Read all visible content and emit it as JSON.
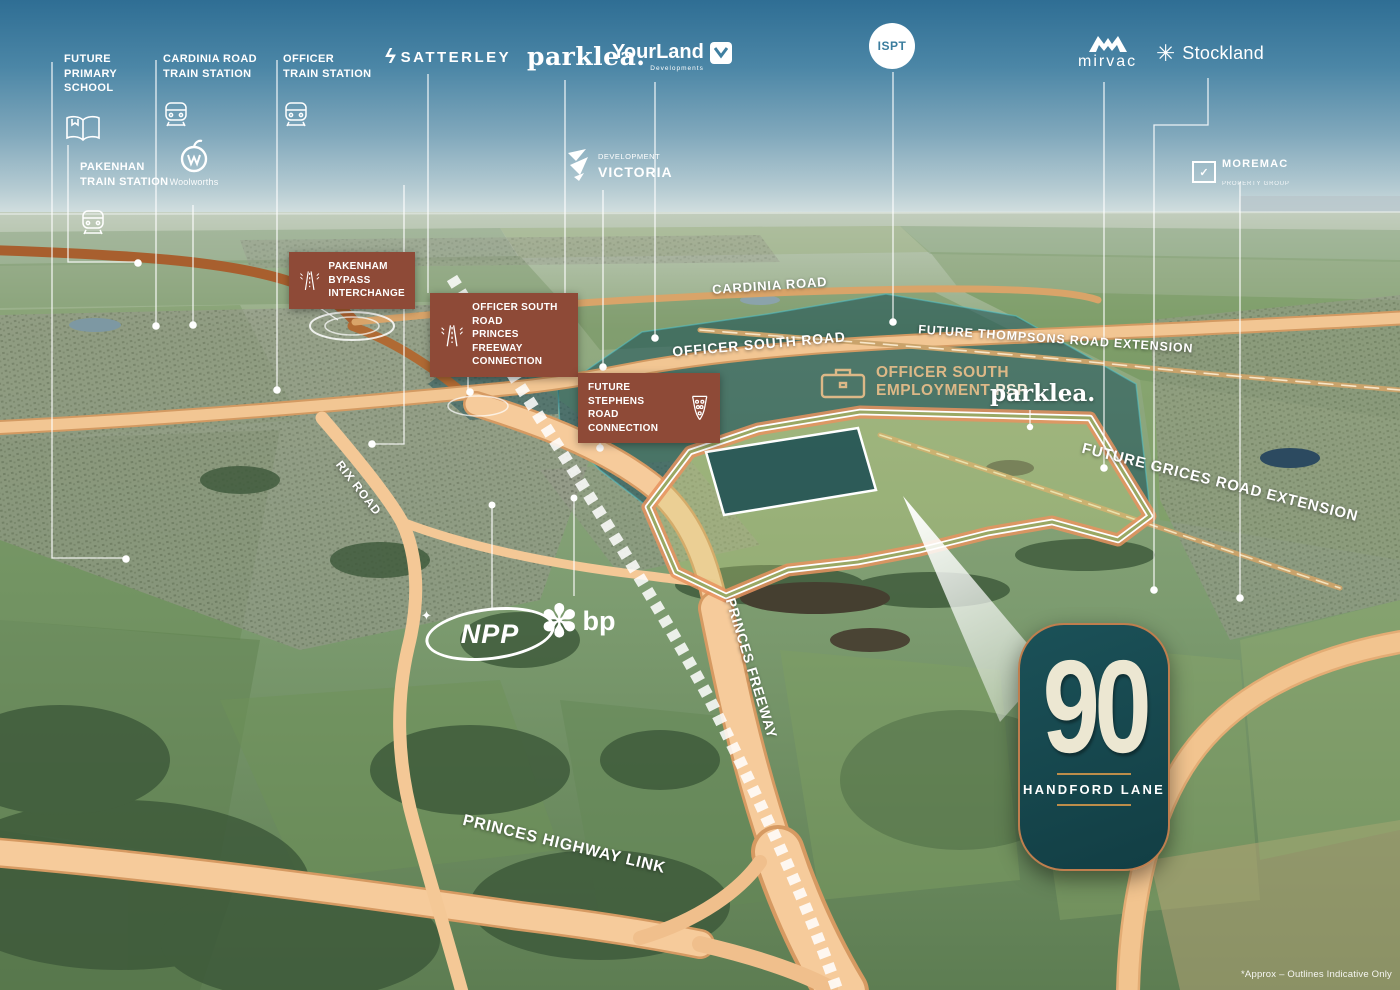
{
  "fine_print": "*Approx – Outlines Indicative Only",
  "badge": {
    "number": "90",
    "name": "HANDFORD LANE"
  },
  "poi": [
    {
      "id": "future-primary-school",
      "text": "FUTURE\nPRIMARY\nSCHOOL",
      "icon": "book-icon"
    },
    {
      "id": "pakenhan-train-station",
      "text": "PAKENHAN\nTRAIN STATION",
      "icon": "train-icon"
    },
    {
      "id": "cardinia-road-train-station",
      "text": "CARDINIA ROAD\nTRAIN STATION",
      "icon": "train-icon"
    },
    {
      "id": "officer-train-station",
      "text": "OFFICER\nTRAIN STATION",
      "icon": "train-icon"
    }
  ],
  "callouts": [
    {
      "id": "pakenham-bypass-interchange",
      "text": "PAKENHAM\nBYPASS\nINTERCHANGE",
      "icon": "freeway-interchange-icon"
    },
    {
      "id": "officer-south-road-connection",
      "text": "OFFICER SOUTH ROAD\nPRINCES FREEWAY\nCONNECTION",
      "icon": "freeway-interchange-icon"
    },
    {
      "id": "future-stephens-road-connection",
      "text": "FUTURE STEPHENS\nROAD CONNECTION",
      "icon": "road-connection-icon"
    }
  ],
  "roads": [
    {
      "id": "cardinia-road",
      "text": "CARDINIA ROAD"
    },
    {
      "id": "officer-south-road",
      "text": "OFFICER SOUTH ROAD"
    },
    {
      "id": "future-thompsons-road-extension",
      "text": "FUTURE THOMPSONS ROAD EXTENSION"
    },
    {
      "id": "future-grices-road-extension",
      "text": "FUTURE GRICES ROAD EXTENSION"
    },
    {
      "id": "rix-road",
      "text": "RIX ROAD"
    },
    {
      "id": "princes-freeway",
      "text": "PRINCES FREEWAY"
    },
    {
      "id": "princes-highway-link",
      "text": "PRINCES HIGHWAY LINK"
    }
  ],
  "areas": {
    "employment_line1": "OFFICER SOUTH",
    "employment_line2": "EMPLOYMENT",
    "employment_psp": "PSP",
    "parklea_site": "parklea."
  },
  "logos": {
    "satterley": "SATTERLEY",
    "parklea": "parklea.",
    "yourland": "YourLand",
    "yourland_sub": "Developments",
    "ispt": "ISPT",
    "mirvac": "mirvac",
    "stockland": "Stockland",
    "woolworths": "Woolworths",
    "devvic_line1": "DEVELOPMENT",
    "devvic_line2": "VICTORIA",
    "moremac": "MOREMAC",
    "moremac_sub": "PROPERTY GROUP",
    "npp": "NPP",
    "bp": "bp"
  },
  "colors": {
    "callout_brown": "#8e4a37",
    "badge_teal": "#16464c",
    "badge_copper": "#bf7e4e",
    "road_peach": "#f5c997",
    "accent_tan": "#dcb887",
    "psp_overlay": "#10485430"
  }
}
